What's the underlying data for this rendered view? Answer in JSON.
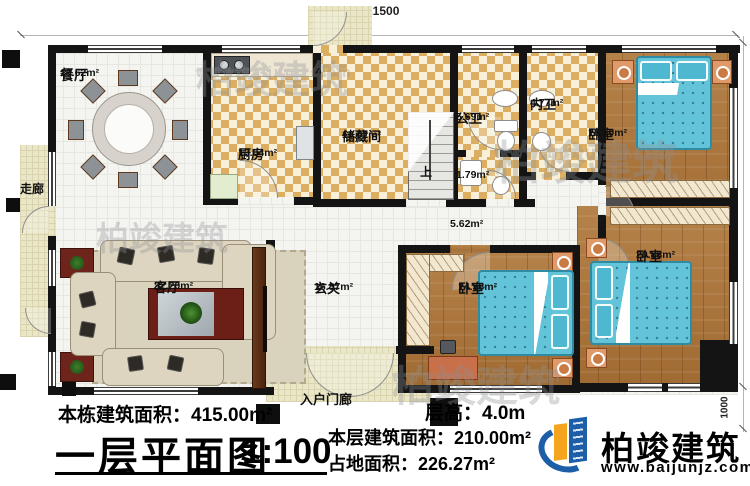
{
  "dimensions": {
    "width_total": "21500",
    "height_total": "10000",
    "bay_depth": "1000"
  },
  "rooms": {
    "corridor": {
      "name": "走廊"
    },
    "dining": {
      "name": "餐厅",
      "area": "19.62m²"
    },
    "kitchen": {
      "name": "厨房",
      "area": "13.04m²"
    },
    "storage": {
      "name": "储藏间",
      "area": "16.02m²"
    },
    "public_bath": {
      "name": "公卫",
      "area": "5.69m²"
    },
    "inner_bath": {
      "name": "内卫",
      "area": "4.77m²"
    },
    "bedroom1": {
      "name": "卧室",
      "area": "18.60m²"
    },
    "bedroom2": {
      "name": "卧室",
      "area": "14.98m²"
    },
    "bedroom3": {
      "name": "卧室",
      "area": "20.83m²"
    },
    "living": {
      "name": "客厅",
      "area": "32.20m²"
    },
    "foyer": {
      "name": "玄关",
      "area": "16.87m²"
    },
    "laundry": {
      "area": "1.79m²"
    },
    "hall": {
      "area": "5.62m²"
    },
    "stairs": {
      "label": "上"
    },
    "entry_porch": {
      "name": "入户门廊"
    }
  },
  "footer": {
    "total_building_area": "本栋建筑面积：415.00m²",
    "plan_title": "一层平面图",
    "scale": "1:100",
    "floor_height": "层高：4.0m",
    "floor_building_area": "本层建筑面积：210.00m²",
    "land_area": "占地面积：226.27m²"
  },
  "logo": {
    "name": "柏竣建筑",
    "website": "www.baijunjz.com"
  },
  "watermark": {
    "text": "柏竣建筑",
    "website": "www.baijunjz.com"
  }
}
